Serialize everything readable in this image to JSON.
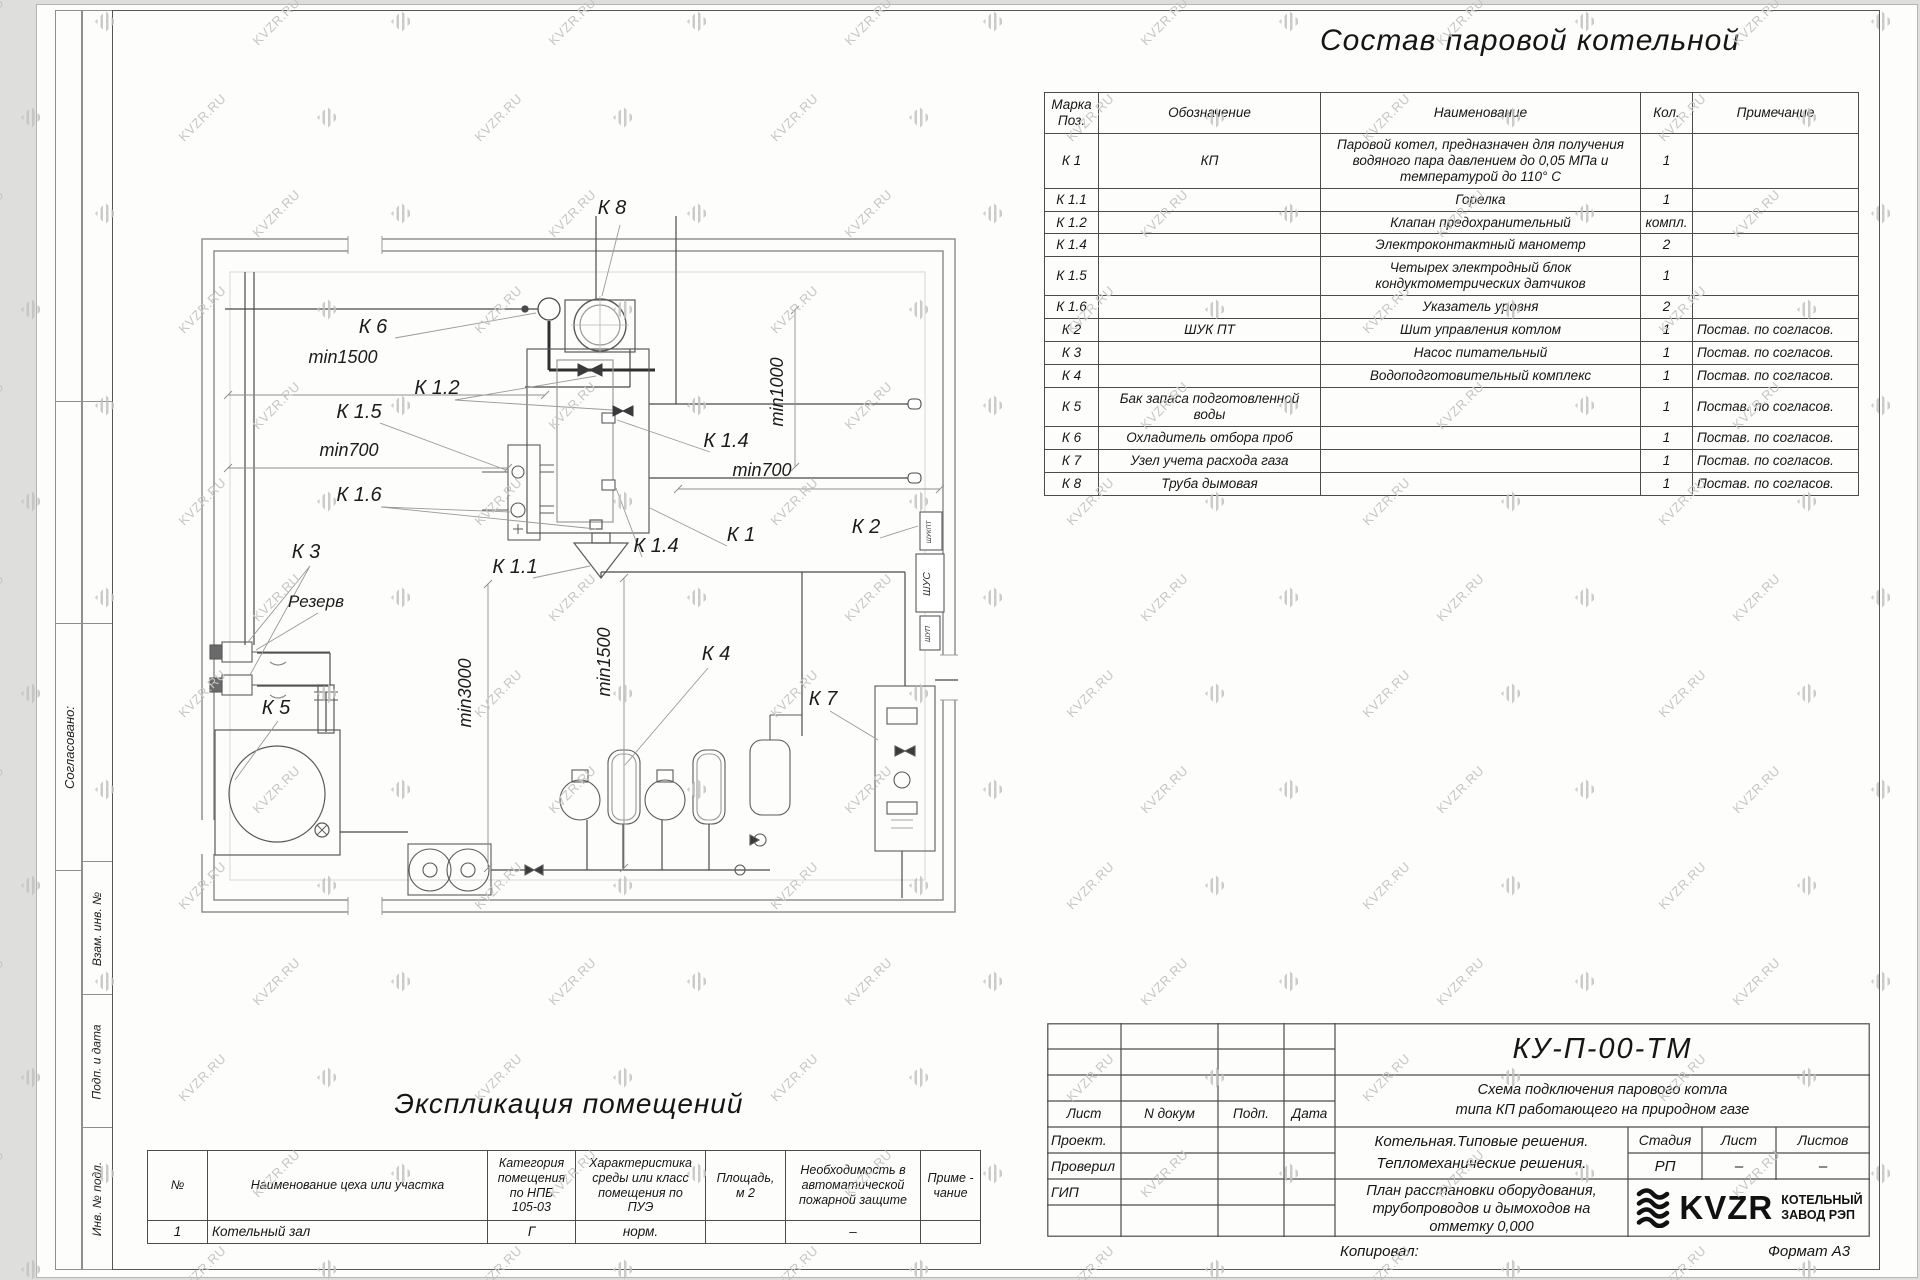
{
  "watermark": {
    "text": "KVZR.RU"
  },
  "sheet": {
    "side_labels": {
      "agreed": "Согласовано:",
      "vzam": "Взам. инв. №",
      "podp": "Подп. и дата",
      "inv": "Инв. № подл."
    }
  },
  "equipment_table": {
    "title": "Состав паровой котельной",
    "columns": [
      "Марка\nПоз.",
      "Обозначение",
      "Наименование",
      "Кол.",
      "Примечание"
    ],
    "rows": [
      {
        "mark": "К 1",
        "designation": "КП",
        "name": "Паровой котел, предназначен для получения водяного пара давлением до  0,05  МПа и температурой до  110° С",
        "qty": "1",
        "note": ""
      },
      {
        "mark": "К 1.1",
        "designation": "",
        "name": "Горелка",
        "qty": "1",
        "note": ""
      },
      {
        "mark": "К 1.2",
        "designation": "",
        "name": "Клапан предохранительный",
        "qty": "компл.",
        "note": ""
      },
      {
        "mark": "К 1.4",
        "designation": "",
        "name": "Электроконтактный манометр",
        "qty": "2",
        "note": ""
      },
      {
        "mark": "К 1.5",
        "designation": "",
        "name": "Четырех электродный блок кондуктометрических датчиков",
        "qty": "1",
        "note": ""
      },
      {
        "mark": "К 1.6",
        "designation": "",
        "name": "Указатель уровня",
        "qty": "2",
        "note": ""
      },
      {
        "mark": "К 2",
        "designation": "ШУК ПТ",
        "name": "Шит управления котлом",
        "qty": "1",
        "note": "Постав. по согласов."
      },
      {
        "mark": "К 3",
        "designation": "",
        "name": "Насос питательный",
        "qty": "1",
        "note": "Постав. по согласов."
      },
      {
        "mark": "К 4",
        "designation": "",
        "name": "Водоподготовительный комплекс",
        "qty": "1",
        "note": "Постав. по согласов."
      },
      {
        "mark": "К 5",
        "designation": "Бак запаса подготовленной воды",
        "name": "",
        "qty": "1",
        "note": "Постав. по согласов."
      },
      {
        "mark": "К 6",
        "designation": "Охладитель отбора проб",
        "name": "",
        "qty": "1",
        "note": "Постав. по согласов."
      },
      {
        "mark": "К 7",
        "designation": "Узел учета расхода газа",
        "name": "",
        "qty": "1",
        "note": "Постав. по согласов."
      },
      {
        "mark": "К 8",
        "designation": "Труба дымовая",
        "name": "",
        "qty": "1",
        "note": "Постав. по согласов."
      }
    ]
  },
  "plan": {
    "labels": [
      {
        "text": "К 8",
        "x": 462,
        "y": 34
      },
      {
        "text": "К 6",
        "x": 223,
        "y": 153
      },
      {
        "text": "min1500",
        "x": 193,
        "y": 183
      },
      {
        "text": "К 1.2",
        "x": 287,
        "y": 214
      },
      {
        "text": "К 1.5",
        "x": 209,
        "y": 238
      },
      {
        "text": "min700",
        "x": 199,
        "y": 276
      },
      {
        "text": "К 1.6",
        "x": 209,
        "y": 321
      },
      {
        "text": "К 1.4",
        "x": 576,
        "y": 267
      },
      {
        "text": "min700",
        "x": 612,
        "y": 296
      },
      {
        "text": "min1000",
        "x": 633,
        "y": 212,
        "rot": -90
      },
      {
        "text": "К 1.4",
        "x": 506,
        "y": 372
      },
      {
        "text": "К 1",
        "x": 591,
        "y": 361
      },
      {
        "text": "К 2",
        "x": 716,
        "y": 353
      },
      {
        "text": "К 1.1",
        "x": 365,
        "y": 393
      },
      {
        "text": "К 3",
        "x": 156,
        "y": 378
      },
      {
        "text": "Резерв",
        "x": 166,
        "y": 427
      },
      {
        "text": "min1500",
        "x": 460,
        "y": 482,
        "rot": -90
      },
      {
        "text": "min3000",
        "x": 321,
        "y": 513,
        "rot": -90
      },
      {
        "text": "К 4",
        "x": 566,
        "y": 480
      },
      {
        "text": "К 5",
        "x": 126,
        "y": 534
      },
      {
        "text": "К 7",
        "x": 673,
        "y": 525
      }
    ],
    "cabinet_labels": [
      "ШУКПТ",
      "ШУС",
      "ШУП"
    ]
  },
  "rooms_table": {
    "title": "Экспликация помещений",
    "columns": [
      "№",
      "Наименование цеха или участка",
      "Категория\nпомещения\nпо НПБ\n105-03",
      "Характеристика\nсреды или класс\nпомещения по\nПУЭ",
      "Площадь,\nм 2",
      "Необходимость в\nавтоматической\nпожарной защите",
      "Приме -\nчание"
    ],
    "rows": [
      [
        "1",
        "Котельный зал",
        "Г",
        "норм.",
        "",
        "–",
        ""
      ]
    ]
  },
  "title_block": {
    "doc_number": "КУ-П-00-ТМ",
    "doc_title_line1": "Схема подключения парового котла",
    "doc_title_line2": "типа КП работающего на природном газе",
    "header_cols": [
      "Лист",
      "N докум",
      "Подп.",
      "Дата"
    ],
    "roles": [
      "Проект.",
      "Проверил",
      "ГИП"
    ],
    "object_line1": "Котельная.Типовые решения.",
    "object_line2": "Тепломеханические решения.",
    "sheet_title_line1": "План расстановки оборудования,",
    "sheet_title_line2": "трубопроводов и дымоходов на",
    "sheet_title_line3": "отметку  0,000",
    "stage_label": "Стадия",
    "sheet_label": "Лист",
    "sheets_label": "Листов",
    "stage": "РП",
    "sheet": "–",
    "sheets": "–",
    "logo_text": "KVZR",
    "logo_sub1": "КОТЕЛЬНЫЙ",
    "logo_sub2": "ЗАВОД РЭП",
    "copied": "Копировал:",
    "format": "Формат А3"
  }
}
